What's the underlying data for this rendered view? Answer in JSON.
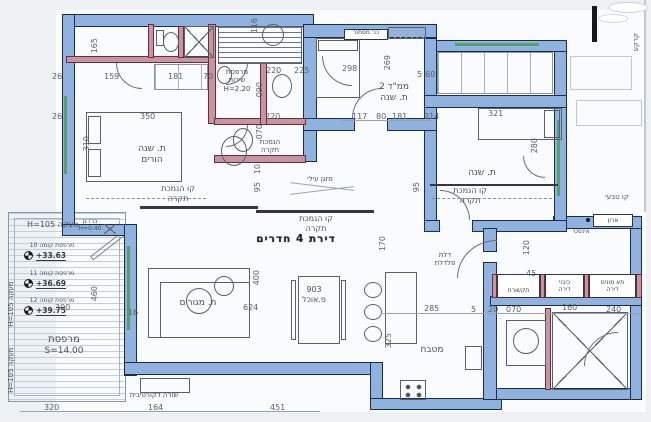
{
  "drawing": {
    "title": "דירת 4 חדרים",
    "rooms": {
      "parents_bedroom": {
        "line1": "ת. שנה",
        "line2": "הורים"
      },
      "service_balcony": {
        "line1": "מרפסת",
        "line2": "שירות",
        "height": "H=2.20"
      },
      "mamad": {
        "line1": "ממ\"ד 2",
        "line2": "ת. שנה"
      },
      "bedroom": {
        "line1": "ת. שנה"
      },
      "living_room": {
        "line1": "ת. מגורים"
      },
      "dining": {
        "code": "903",
        "line1": "פ.אוכל"
      },
      "kitchen": {
        "line1": "מטבח"
      },
      "balcony": {
        "line1": "מרפסת",
        "area": "S=14.00"
      }
    },
    "annotations": {
      "ceiling_line": {
        "line1": "קו הנמכת",
        "line2": "תקרה"
      },
      "ceiling_drop": {
        "line1": "הנמכת",
        "line2": "תקרה"
      },
      "ac_unit": "מזגן עילי",
      "steel_door": {
        "line1": "דלת",
        "line2": "פלדלת"
      },
      "railing_top": "מעקה H=105",
      "railing_side": "מעקה H=105",
      "decorative_row": "שורה דקורטיבית",
      "garden_tap": {
        "line1": "ברז גן",
        "line2": "H=0.40"
      },
      "natural_line": "קו טבעי",
      "ground": "קרקע",
      "laundry_screen": "כנ' מסתור",
      "plumbing_cabinet": {
        "line1": "ארון",
        "line2": "אינסט'"
      },
      "comm_closet": "תקשורת",
      "fire_closet": {
        "line1": "כיבוי",
        "line2": "דירה"
      },
      "meters_closet": {
        "line1": "תא מונים",
        "line2": "דירה"
      }
    },
    "elevation_markers": [
      {
        "label": "מרפסת קומה",
        "floor": "10",
        "value": "+33.63"
      },
      {
        "label": "מרפסת קומה",
        "floor": "11",
        "value": "+36.69"
      },
      {
        "label": "מרפסת קומה",
        "floor": "12",
        "value": "+39.75"
      }
    ],
    "dims": [
      "165",
      "26",
      "159",
      "181",
      "70",
      "116",
      "220",
      "225",
      "298",
      "269",
      "5",
      "60",
      "090",
      "350",
      "26",
      "310",
      "220",
      "070",
      "117",
      "80",
      "181",
      "214",
      "321",
      "280",
      "10",
      "95",
      "95",
      "120",
      "45",
      "170",
      "400",
      "624",
      "285",
      "5",
      "20",
      "070",
      "160",
      "240",
      "325",
      "300",
      "460",
      "16",
      "320",
      "164",
      "451"
    ],
    "colors": {
      "wall": "#8fb3de",
      "partition": "#c795a1",
      "outline": "#1d2b4f",
      "ink": "#4a4f57",
      "window": "#58a06a",
      "paper": "#eef1f4"
    }
  }
}
